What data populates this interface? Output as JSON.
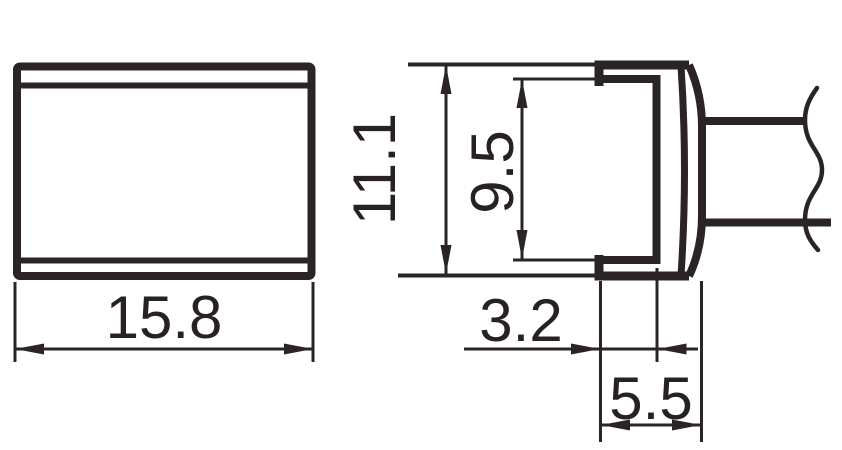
{
  "colors": {
    "background": "#ffffff",
    "line": "#2b2425",
    "text": "#272122"
  },
  "dimensions": {
    "front_width": "15.8",
    "side_height": "11.1",
    "side_inner_height": "9.5",
    "side_slot_depth": "3.2",
    "side_head_depth": "5.5"
  }
}
